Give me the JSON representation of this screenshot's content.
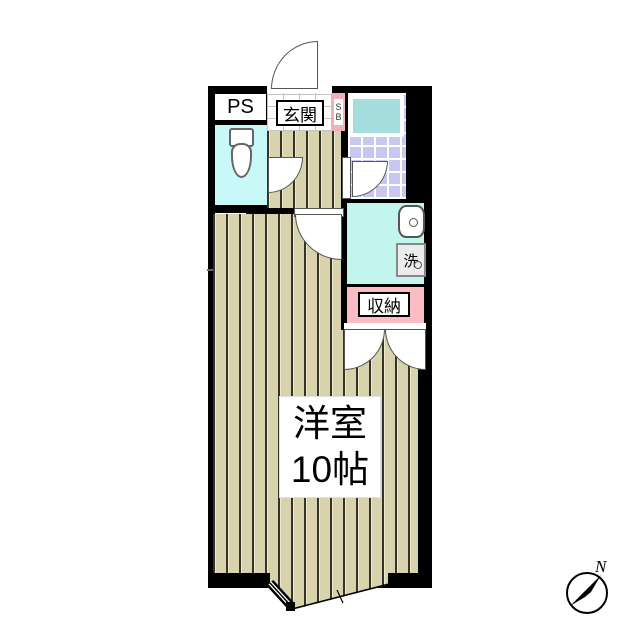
{
  "plan": {
    "rooms": {
      "pipe_space": {
        "label": "PS"
      },
      "entrance": {
        "label": "玄関"
      },
      "shoe_box": {
        "label_top": "S",
        "label_bottom": "B"
      },
      "laundry": {
        "washer_label": "洗"
      },
      "closet": {
        "label": "収納"
      },
      "main_room": {
        "type_label": "洋室",
        "size_label": "10帖"
      }
    },
    "compass": {
      "north_label": "N"
    },
    "colors": {
      "wall": "#000000",
      "floor": "#d8d3ac",
      "floor-stripe": "#33332a",
      "toilet-room": "#c9f8f8",
      "laundry-room": "#c2f5ee",
      "bath-tile": "#c7c7f0",
      "bathtub": "#a5dcdc",
      "closet-pink": "#f8bcc2",
      "shoebox-pink": "#f3afb8"
    }
  }
}
